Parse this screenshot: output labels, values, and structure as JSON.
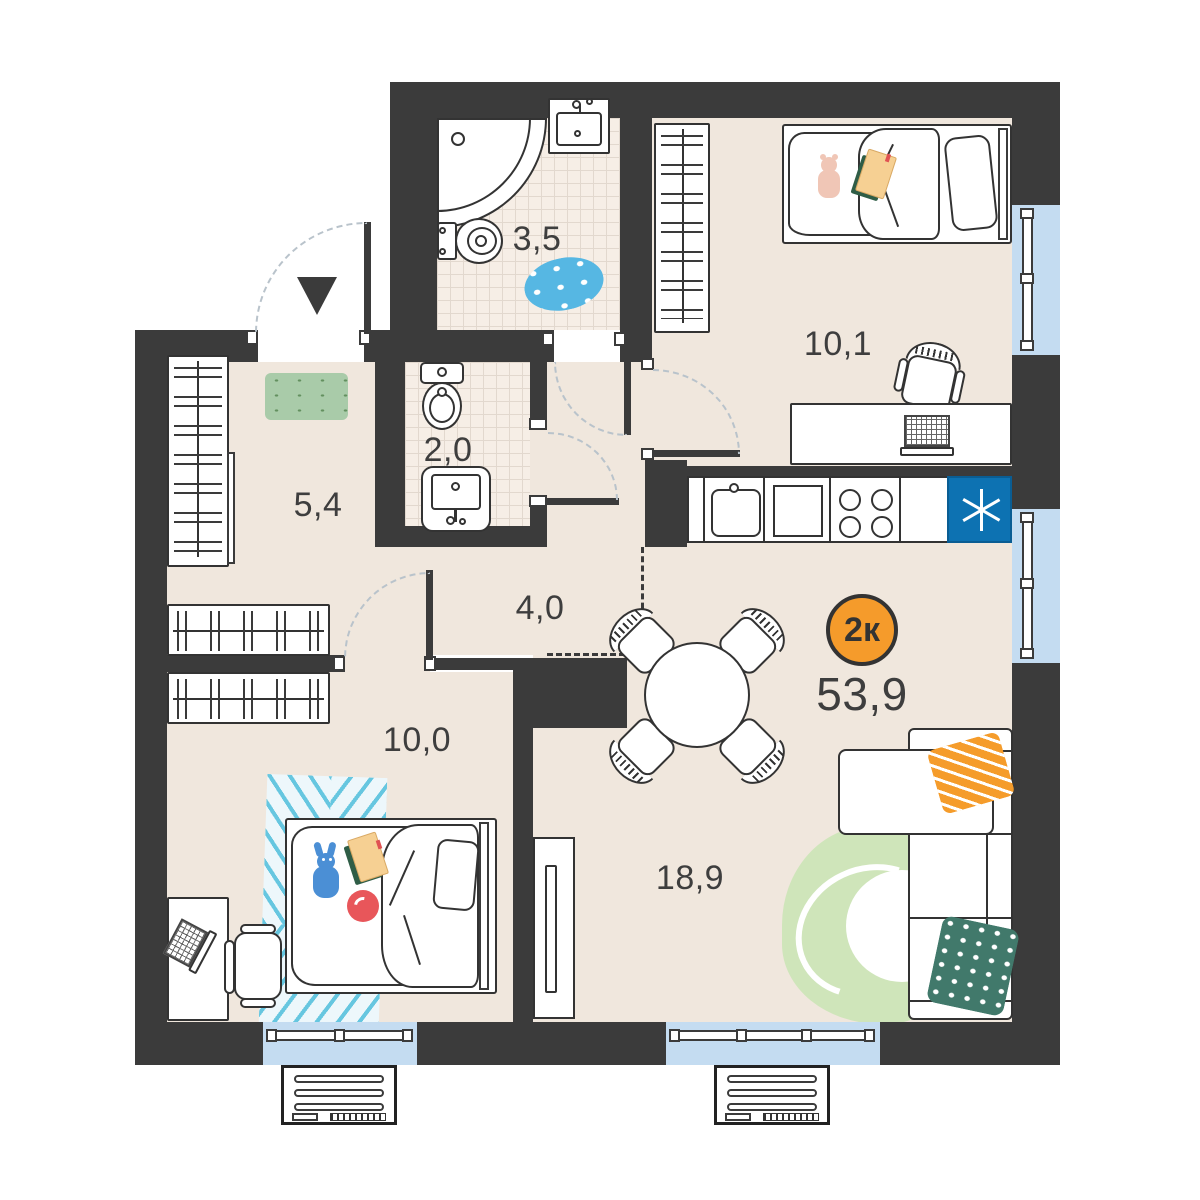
{
  "badge": {
    "label": "2к",
    "color": "#F59B2B"
  },
  "total_area": "53,9",
  "rooms": {
    "bathroom": {
      "label": "3,5"
    },
    "wc": {
      "label": "2,0"
    },
    "hallway": {
      "label": "5,4"
    },
    "corridor": {
      "label": "4,0"
    },
    "bedroom_top": {
      "label": "10,1"
    },
    "bedroom_bottom": {
      "label": "10,0"
    },
    "living_kitchen": {
      "label": "18,9"
    }
  },
  "icons": {
    "fridge": "six-spoke-asterisk",
    "entrance": "down-triangle"
  },
  "colors": {
    "wall": "#3B3B3B",
    "floor": "#F0E7DD",
    "tile": "#F6EEE6",
    "window": "#C4DCF1",
    "fridge": "#0D72B2",
    "accent_orange": "#F59B2B",
    "pillow_green": "#41796B",
    "rug_green": "#CFE5BA",
    "rug_hall": "#A9CBA9",
    "rug_blue_stripe": "#5FC4DD",
    "bath_rug": "#56B7E3"
  }
}
